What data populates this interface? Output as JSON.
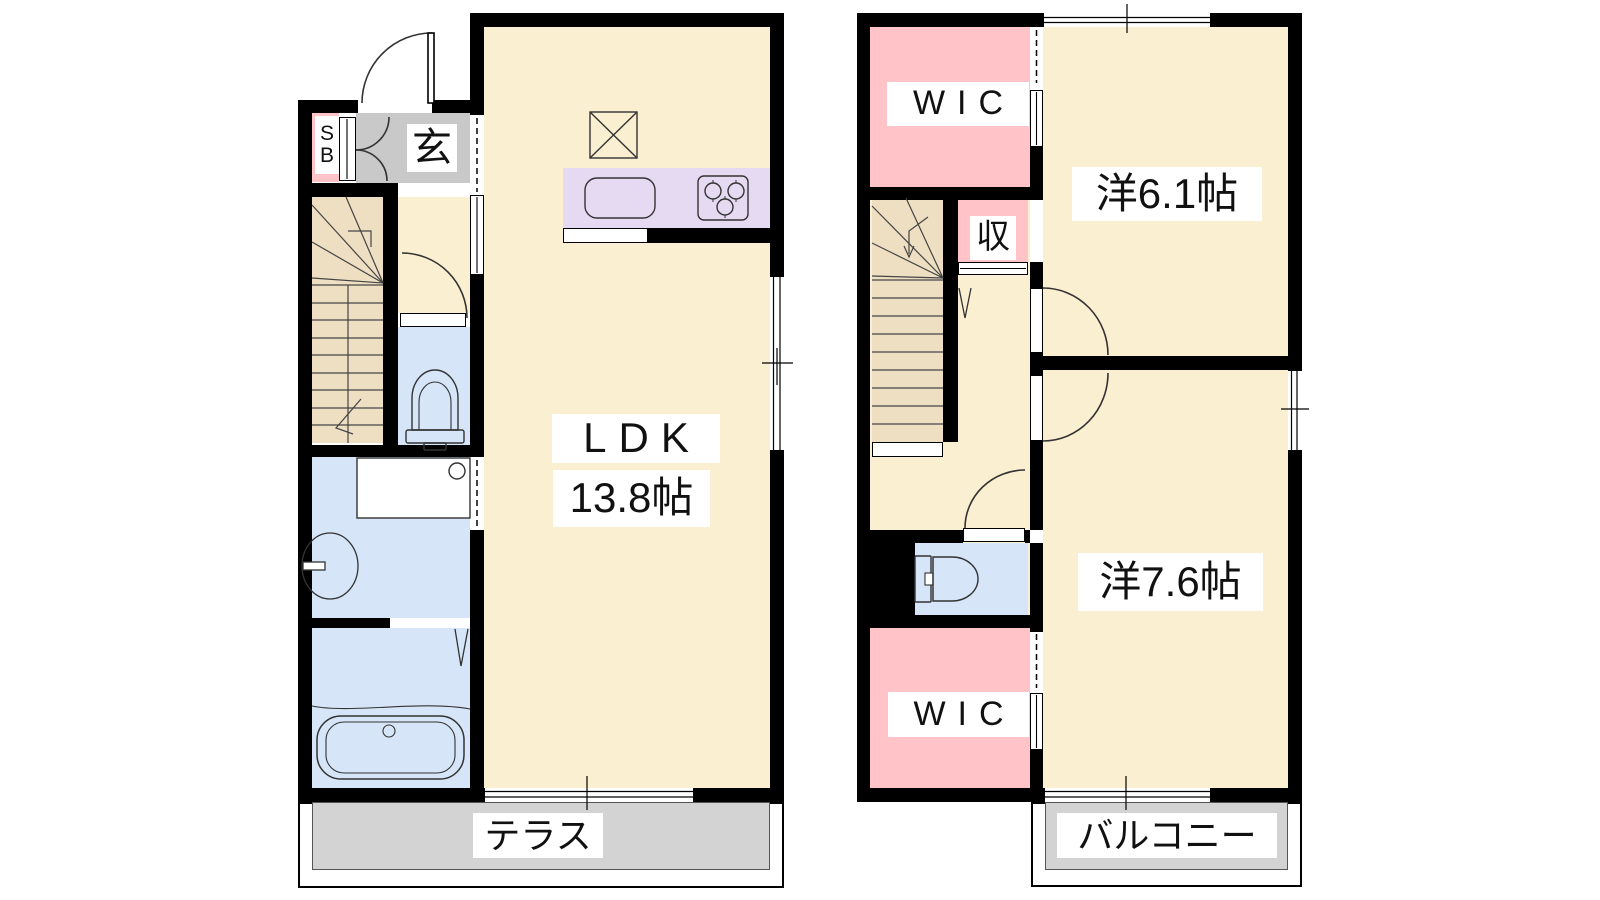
{
  "document": {
    "type": "floor-plan",
    "floors": 2
  },
  "colors": {
    "wall": "#000000",
    "room_cream": "#FBEFD1",
    "stairs_tan": "#EEDFC3",
    "closet_pink": "#FFC3C8",
    "wet_blue": "#D6E5F7",
    "kitchen_lavender": "#E6DAF2",
    "terrace_gray": "#D3D3D3",
    "entrance_gray": "#C9C9C9"
  },
  "floor1": {
    "rooms": {
      "ldk": {
        "label": "LDK",
        "size": "13.8帖"
      },
      "entrance": {
        "label": "玄"
      },
      "shoe_box": {
        "label": "SB"
      },
      "terrace": {
        "label": "テラス"
      }
    }
  },
  "floor2": {
    "rooms": {
      "wic_north": {
        "label": "WIC"
      },
      "bedroom_6_1": {
        "label": "洋6.1帖"
      },
      "storage": {
        "label": "収"
      },
      "bedroom_7_6": {
        "label": "洋7.6帖"
      },
      "wic_south": {
        "label": "WIC"
      },
      "balcony": {
        "label": "バルコニー"
      }
    }
  }
}
